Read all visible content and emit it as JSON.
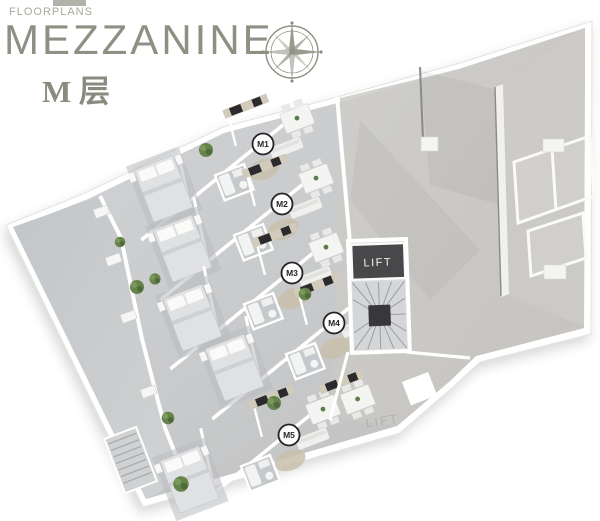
{
  "header": {
    "eyebrow": "FLOORPLANS",
    "title": "MEZZANINE",
    "subtitle": "M 层"
  },
  "compass": {
    "icon": "compass-rose-icon",
    "color": "#8e9083"
  },
  "plan": {
    "units": [
      {
        "label": "M1"
      },
      {
        "label": "M2"
      },
      {
        "label": "M3"
      },
      {
        "label": "M4"
      },
      {
        "label": "M5"
      }
    ],
    "lift_shaft_label": "LIFT",
    "lift_floor_label": "LIFT",
    "colors": {
      "title_olive": "#8f9083",
      "floor_gray": "#c9cbcd",
      "wall_white": "#ffffff",
      "lift_box_dark": "#48484a",
      "plant_green": "#5e7c45",
      "rug_beige": "#c8c0ac"
    }
  }
}
